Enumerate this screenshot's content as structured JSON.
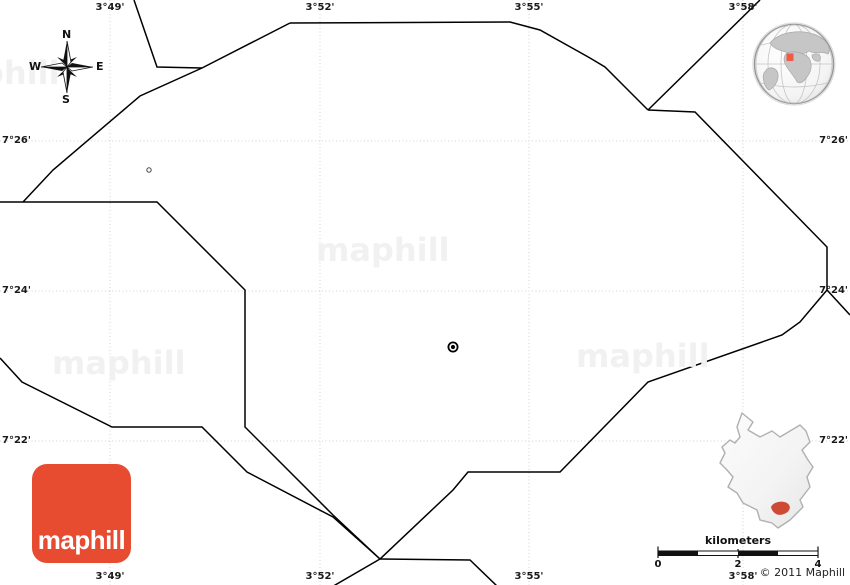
{
  "map": {
    "type": "blank-simple-map",
    "background": "#ffffff",
    "boundaries": [
      {
        "id": "b1",
        "points": [
          [
            134,
            0
          ],
          [
            157,
            67
          ],
          [
            202,
            68
          ]
        ]
      },
      {
        "id": "b2",
        "points": [
          [
            290,
            23
          ],
          [
            202,
            68
          ],
          [
            140,
            96
          ],
          [
            53,
            170
          ],
          [
            23,
            202
          ]
        ]
      },
      {
        "id": "b3",
        "points": [
          [
            0,
            202
          ],
          [
            157,
            202
          ],
          [
            245,
            290
          ],
          [
            245,
            427
          ],
          [
            333,
            515
          ],
          [
            380,
            559
          ]
        ]
      },
      {
        "id": "b4",
        "points": [
          [
            0,
            358
          ],
          [
            22,
            382
          ],
          [
            112,
            427
          ],
          [
            202,
            427
          ],
          [
            247,
            472
          ],
          [
            333,
            517
          ],
          [
            380,
            559
          ]
        ]
      },
      {
        "id": "b5",
        "points": [
          [
            290,
            23
          ],
          [
            510,
            22
          ],
          [
            540,
            30
          ],
          [
            590,
            58
          ],
          [
            605,
            67
          ],
          [
            648,
            110
          ]
        ]
      },
      {
        "id": "b6",
        "points": [
          [
            760,
            0
          ],
          [
            648,
            110
          ]
        ]
      },
      {
        "id": "b7",
        "points": [
          [
            648,
            110
          ],
          [
            695,
            112
          ],
          [
            827,
            247
          ],
          [
            827,
            290
          ]
        ]
      },
      {
        "id": "b8",
        "points": [
          [
            827,
            290
          ],
          [
            800,
            322
          ],
          [
            782,
            335
          ],
          [
            648,
            382
          ],
          [
            560,
            472
          ],
          [
            468,
            472
          ],
          [
            453,
            490
          ],
          [
            380,
            559
          ]
        ]
      },
      {
        "id": "b9",
        "points": [
          [
            827,
            290
          ],
          [
            850,
            315
          ]
        ]
      },
      {
        "id": "b10",
        "points": [
          [
            380,
            559
          ],
          [
            330,
            588
          ]
        ]
      },
      {
        "id": "b11",
        "points": [
          [
            380,
            559
          ],
          [
            470,
            560
          ],
          [
            498,
            587
          ]
        ]
      }
    ],
    "markers": [
      {
        "type": "circled-dot",
        "x": 453,
        "y": 347
      },
      {
        "type": "ring",
        "x": 149,
        "y": 170
      }
    ]
  },
  "grid": {
    "meridians": [
      {
        "label": "3°49'",
        "x": 110
      },
      {
        "label": "3°52'",
        "x": 320
      },
      {
        "label": "3°55'",
        "x": 529
      },
      {
        "label": "3°58'",
        "x": 743
      }
    ],
    "parallels": [
      {
        "label": "7°26'",
        "y": 141
      },
      {
        "label": "7°24'",
        "y": 291
      },
      {
        "label": "7°22'",
        "y": 441
      }
    ]
  },
  "compass": {
    "north": "N",
    "west": "W",
    "east": "E",
    "south": "S"
  },
  "watermarks": [
    {
      "text": "maphill",
      "x": -74,
      "y": 58
    },
    {
      "text": "maphill",
      "x": 316,
      "y": 235
    },
    {
      "text": "maphill",
      "x": 52,
      "y": 348
    },
    {
      "text": "maphill",
      "x": 576,
      "y": 341
    }
  ],
  "logo": {
    "text": "maphill",
    "color": "#e74c31"
  },
  "scalebar": {
    "title": "kilometers",
    "ticks": [
      {
        "label": "0",
        "x": 8
      },
      {
        "label": "2",
        "x": 88
      },
      {
        "label": "4",
        "x": 168
      }
    ]
  },
  "copyright": "© 2011 Maphill",
  "colors": {
    "boundary_line": "#000000",
    "gridline": "#d2d2d2",
    "label_text": "#1a1a1a",
    "watermark": "#f1f1f1",
    "logo_red": "#e74c31",
    "globe_marker_red": "#ef5b47",
    "inset_region_red": "#cf4a35",
    "globe_land_gray": "#c6c6c6",
    "inset_fill": "#f5f5f5"
  }
}
